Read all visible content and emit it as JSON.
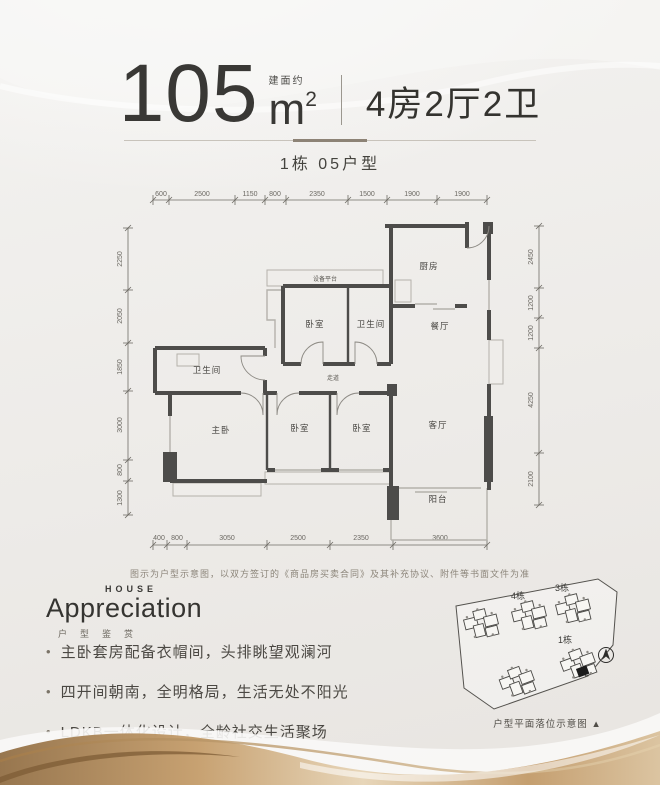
{
  "header": {
    "area_label": "建面约",
    "area_value": "105",
    "area_unit": "m",
    "area_unit_sup": "2",
    "rooms_summary": "4房2厅2卫",
    "unit_title": "1栋  05户型"
  },
  "plan": {
    "dims": {
      "top": [
        "600",
        "2500",
        "1150",
        "800",
        "2350",
        "1500",
        "1900",
        "1900"
      ],
      "left": [
        "2250",
        "2050",
        "1850",
        "3000",
        "800",
        "1300"
      ],
      "right": [
        "2450",
        "1200",
        "1200",
        "4250",
        "2100"
      ],
      "bottom": [
        "400",
        "800",
        "3050",
        "2500",
        "2350",
        "3600"
      ]
    },
    "rooms": {
      "kitchen": "厨房",
      "dining": "餐厅",
      "living": "客厅",
      "balcony": "阳台",
      "equipment_platform": "设备平台",
      "bedroom_mid": "卧室",
      "bathroom_mid": "卫生间",
      "bathroom_left": "卫生间",
      "corridor": "走道",
      "master_bedroom": "主卧",
      "bedroom_b1": "卧室",
      "bedroom_b2": "卧室"
    },
    "disclaimer": "图示为户型示意图，以双方签订的《商品房买卖合同》及其补充协议、附件等书面文件为准"
  },
  "logo": {
    "en_top": "HOUSE",
    "en_main": "Appreciation",
    "cn_caption": "户型鉴赏"
  },
  "features": {
    "dot": "•",
    "items": [
      "主卧套房配备衣帽间，头排眺望观澜河",
      "四开间朝南，全明格局，生活无处不阳光",
      "LDKB一体化设计，全龄社交生活聚场"
    ]
  },
  "siteplan": {
    "building_labels": [
      "4栋",
      "3栋",
      "1栋"
    ],
    "caption": "户型平面落位示意图 ▲"
  },
  "colors": {
    "ink": "#393835",
    "wall": "#4d4c4a",
    "gold": "#b08a57",
    "background": "#efede9"
  }
}
